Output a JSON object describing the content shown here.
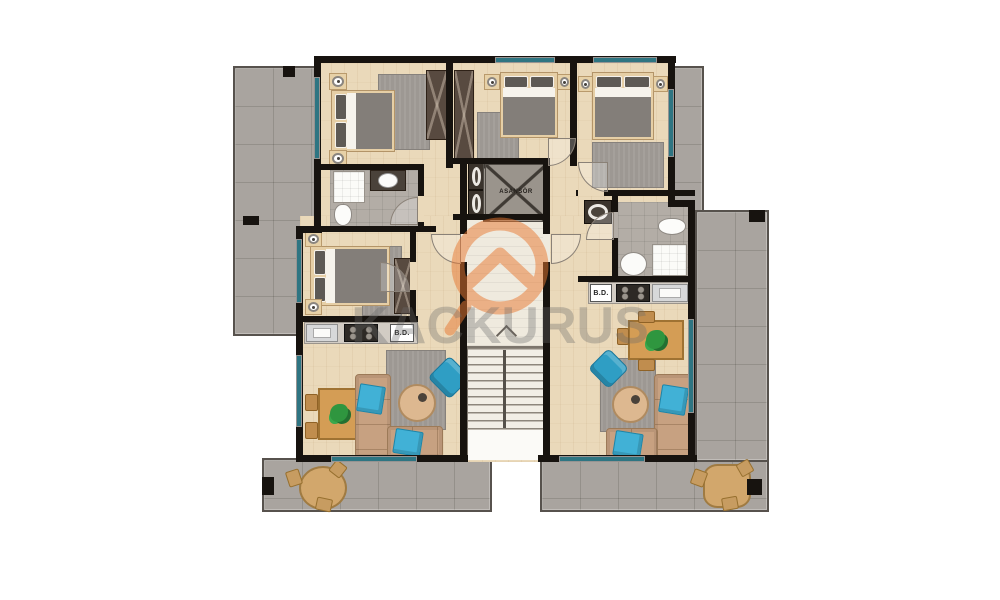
{
  "watermark": {
    "text": "KACKURUS",
    "logo_color": "#e87730"
  },
  "labels": {
    "elevator": "ASANSÖR",
    "bd_left": "B.D.",
    "bd_right": "B.D."
  },
  "colors": {
    "wall": "#17130f",
    "terrace": "#a9a49f",
    "wood": "#ead9ba",
    "bath": "#b3ada6",
    "corridor": "#efeade",
    "glass": "#2e7582",
    "wardrobe": "#584a40",
    "rug": "#9d9893",
    "blanket": "#837e79",
    "sofa": "#c7a181",
    "pillow": "#41b1d6",
    "armchair": "#2f9ec4",
    "table": "#d49d55",
    "plant": "#2f963f",
    "stair": "#f2eee6"
  }
}
